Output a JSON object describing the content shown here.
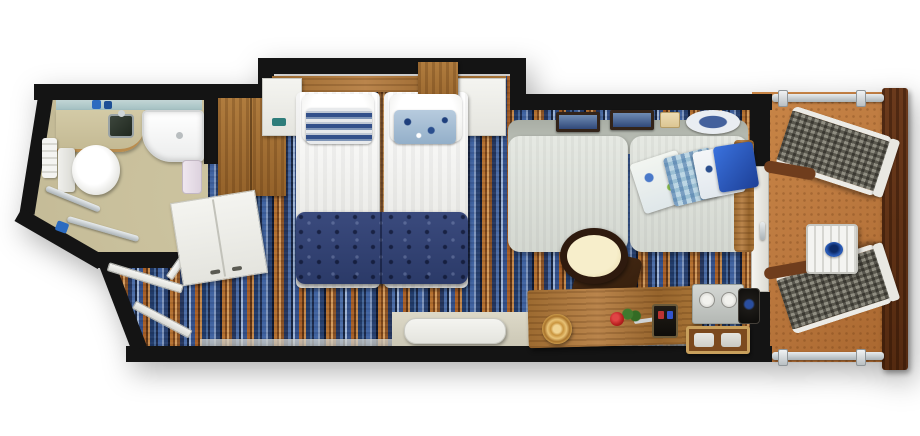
{
  "document": {
    "kind": "floor-plan illustration",
    "subject": "cruise ship balcony stateroom, top-down view",
    "visible_text": "none"
  },
  "palette": {
    "wall": "#141414",
    "bathroom_floor": "#c9c09c",
    "carpet_blue": "#3f62a0",
    "carpet_orange": "#b4702f",
    "bed_runner": "#32406f",
    "sofa": "#dfe3dd",
    "desk_wood": "#a9763a",
    "balcony_floor": "#bd7a40",
    "railing_wood": "#5f2f16",
    "accent_blue": "#2456b8"
  },
  "labels": {
    "plan": "Balcony stateroom floor plan",
    "bathroom": "Bathroom",
    "glass_shelf": "Glass shelf with toiletries",
    "vanity": "Sink vanity",
    "sink": "Sink",
    "toilet": "Toilet",
    "towels": "Towel stack",
    "shower": "Shower / bathtub",
    "grab_bar": "Grab bar",
    "bath_door": "Bathroom door",
    "closet": "Wood closet",
    "wardrobe": "White wardrobe",
    "entry_door": "Entrance door",
    "carpet": "Striped carpet",
    "headboard": "Wood headboard",
    "nightstand_left": "Bedside shelf (left)",
    "nightstand_right": "Bedside shelf (right)",
    "overhead_cabinet": "Overhead wood cabinet",
    "bed_left": "Twin bed (left)",
    "bed_right": "Twin bed (right)",
    "pillow_striped": "Striped accent pillow",
    "pillow_floral": "Floral accent pillow",
    "runner": "Patterned bed runner",
    "tv_shelf": "Wall shelf",
    "sofa": "Sofa",
    "sofa_pillows": "Decorative pillows",
    "wall_art": "Framed wall art",
    "plate": "Decorative plate",
    "chair": "Chair with cream seat",
    "desk": "Wood desk",
    "ornament": "Round gold ornament",
    "rose": "Rose",
    "phone": "Telephone",
    "cup_tray": "Tray with glasses",
    "ice_bucket": "Ice bucket",
    "bottle_tray": "Tray with bottles",
    "balcony": "Balcony",
    "balcony_door": "Sliding glass door",
    "lounger": "Mesh lounge chair",
    "balcony_table": "Slatted balcony table",
    "bowl": "Blue bowl",
    "railing": "Wood balcony railing",
    "rail_post": "Railing post"
  }
}
